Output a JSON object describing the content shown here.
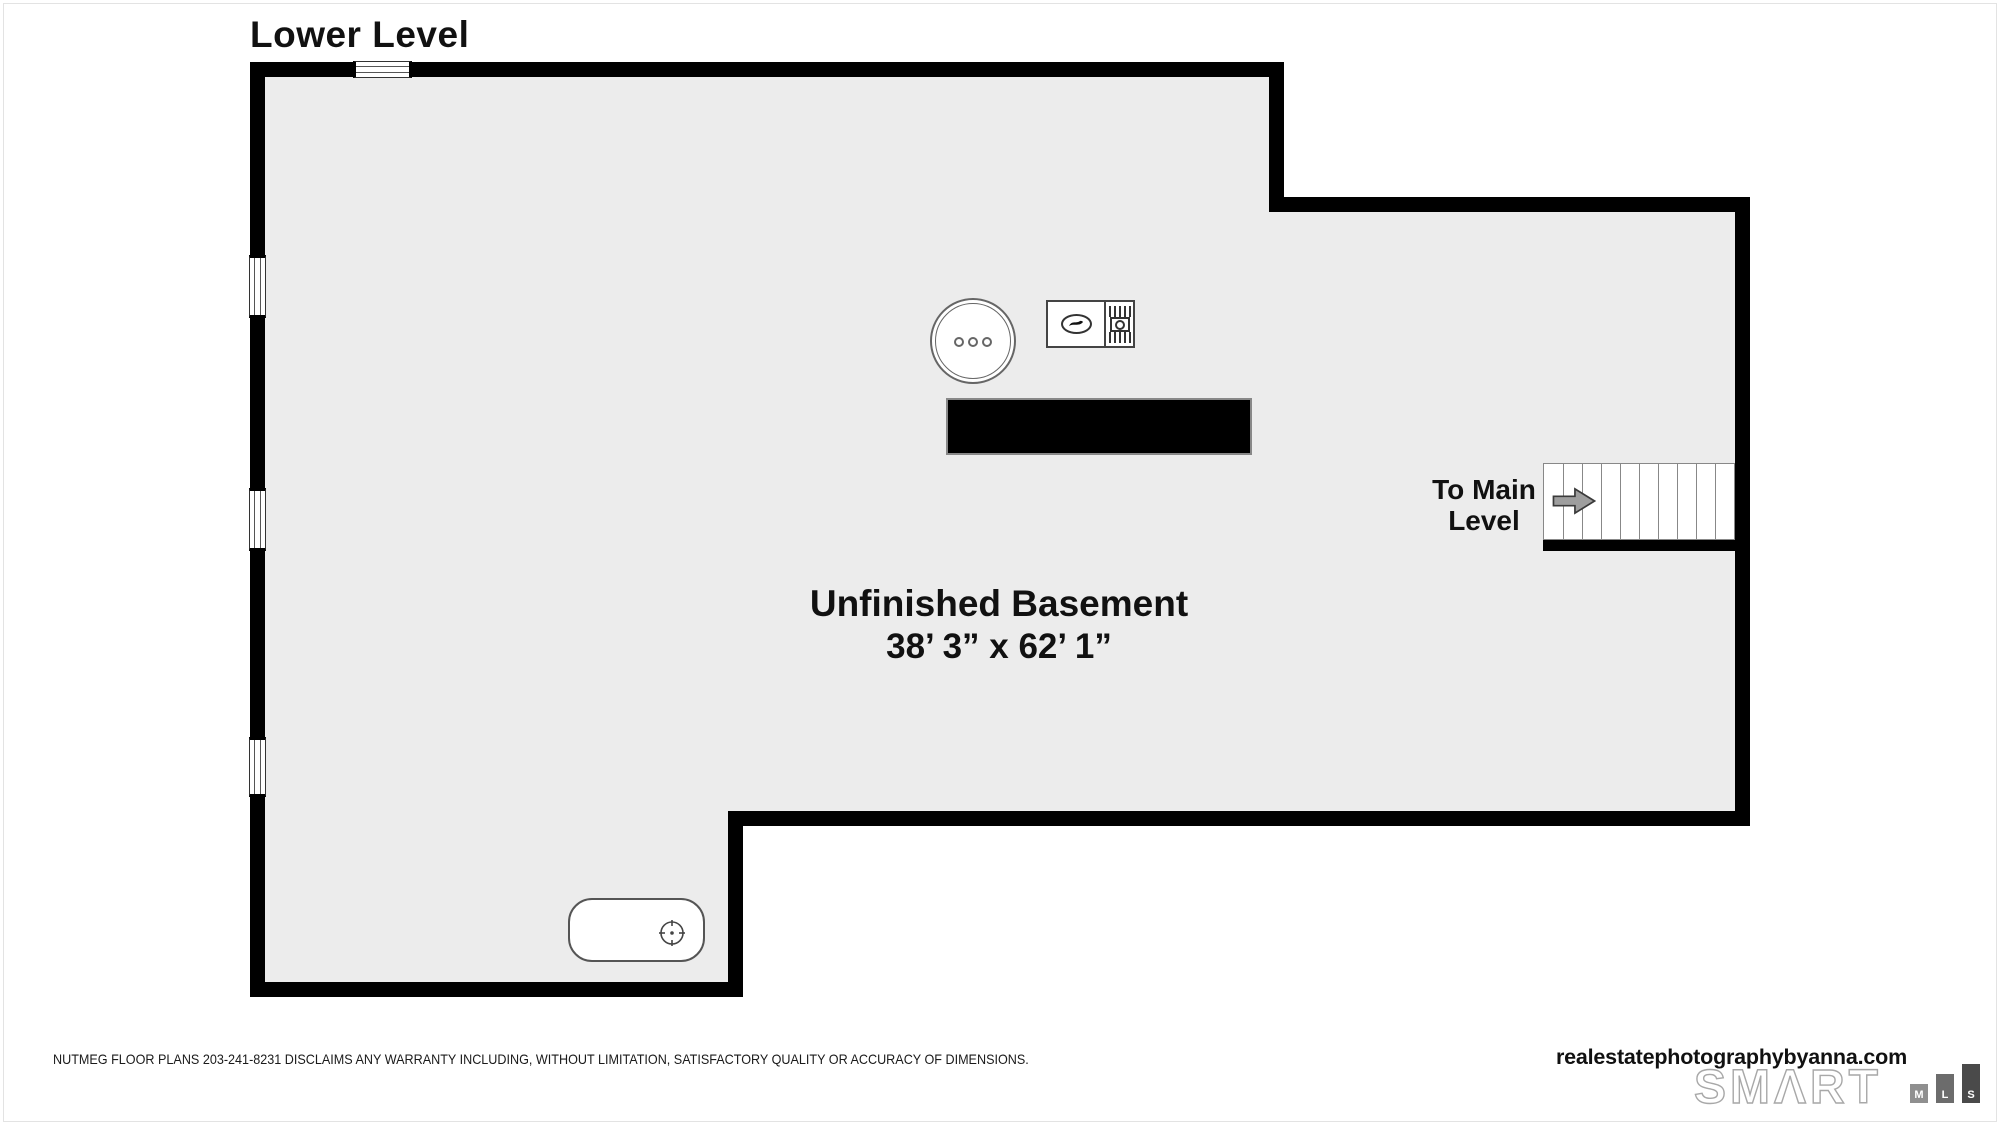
{
  "page": {
    "title": "Lower Level"
  },
  "plan": {
    "room": {
      "name": "Unfinished Basement",
      "dimensions": "38’ 3” x 62’ 1”"
    },
    "stairs": {
      "label_line1": "To Main",
      "label_line2": "Level",
      "treads": 10,
      "direction_icon": "right-arrow"
    },
    "fixtures": {
      "well_tank": "well-pressure-tank",
      "furnace": "furnace-unit",
      "oil_tank": "oil-tank",
      "beam": "structural-beam",
      "windows": 4
    },
    "colors": {
      "wall": "#000000",
      "floor": "#ececec",
      "arrow": "#9e9e9e"
    }
  },
  "footer": {
    "disclaimer": "NUTMEG FLOOR PLANS 203-241-8231 DISCLAIMS ANY WARRANTY INCLUDING, WITHOUT LIMITATION, SATISFACTORY QUALITY OR ACCURACY OF DIMENSIONS.",
    "website": "realestatephotographybyanna.com",
    "logo": {
      "smart": "SMΛRT",
      "mls": [
        "M",
        "L",
        "S"
      ]
    }
  }
}
